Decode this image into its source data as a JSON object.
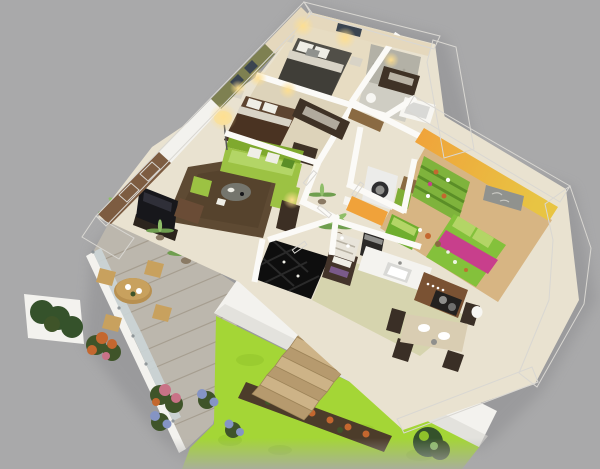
{
  "scene": {
    "title": "Isometric 3D render of a three-bedroom house floor plan with terrace and garden",
    "view": "cutaway dollhouse top-down perspective",
    "background": "#a9a9aa"
  },
  "colors": {
    "bg": "#a9a9aa",
    "wallWhite": "#f3f2ee",
    "wallShade": "#d9d7d2",
    "cream": "#e9e2d0",
    "creamDark": "#ddd3ba",
    "beigeWall": "#e5d8bd",
    "masterFloor": "#e7dcc2",
    "oliveWall": "#7e8051",
    "brownWall": "#7d5c41",
    "windowDark": "#3a4450",
    "stoneWall": "#b3b1a6",
    "stoneFloor": "#cfcdc3",
    "tubWhite": "#f7f6f2",
    "rug": "#5e4a33",
    "rugDark": "#4e3c28",
    "sofa": "#9cc243",
    "sofaLight": "#b3d566",
    "sofaDark": "#7fa92e",
    "pillowWhite": "#efeee6",
    "tableGray": "#75756d",
    "tv": "#17171b",
    "tvStand": "#2c241d",
    "armchair": "#6a4c36",
    "console": "#3c2f24",
    "lampShade": "#f3e1ab",
    "glow": "#ffdf8f",
    "bedGray": "#514f48",
    "bedGrayDark": "#403e38",
    "bedBrown": "#5d4430",
    "bedBrownDark": "#4a3322",
    "foldWhite": "#d8d3c6",
    "wood": "#3f3226",
    "kidsOrange": "#f0a23a",
    "kidsGold": "#e8c443",
    "kidsFloor": "#d7b583",
    "shelfGreen": "#7fb33c",
    "shelfGreenDark": "#5b8e27",
    "kidsBed": "#84c13b",
    "magenta": "#c83f8c",
    "chestGreen": "#6fae2e",
    "frameGray": "#90928e",
    "washer": "#ececea",
    "washerDoor": "#2e2e30",
    "basketGreen": "#7fae35",
    "basketBrown": "#8a6a42",
    "counterWhite": "#f4f3ef",
    "counterWood": "#7a5233",
    "cooktop": "#23211f",
    "sinkGray": "#d9d9d6",
    "coffee": "#2b2927",
    "shelfWood": "#43342a",
    "dishShelf": "#e8e4da",
    "steel": "#8f8f8c",
    "tableTop": "#d9cdb2",
    "chairDark": "#3a2f26",
    "plateWhite": "#ffffff",
    "stackPurple": "#7a5a8a",
    "deck": "#bcb7ad",
    "deckSeam": "#a69e90",
    "glass": "#ccd6d8",
    "glassPost": "#8a9296",
    "rattan": "#c8a15e",
    "rattanDark": "#b89050",
    "palm": "#6f9e4f",
    "palmLight": "#8fbe69",
    "trunk": "#7a5f42",
    "pot": "#8a7a64",
    "hedge": "#35522b",
    "flowerOrange": "#c4672f",
    "flowerPink": "#c97287",
    "foliage": "#3f5429",
    "grass": "#a4d636",
    "grassDark": "#8fc22a",
    "soil": "#4c3c2a",
    "blueFlower": "#8594c4",
    "stepLight": "#cdb387",
    "stepDark": "#b69a6e",
    "stepEdge": "#9d8459",
    "black0": "#0e0e0e",
    "diamond": "#2a2a2a",
    "sage": "#d6d4ae",
    "doorWhite": "#fbfaf7"
  },
  "rooms": {
    "master_bedroom": {
      "label": "Master bedroom",
      "wall": "beige",
      "furniture": [
        "double bed with gray bedding",
        "white patterned pillows",
        "two nightstands",
        "two warm wall sconces",
        "dark wardrobe"
      ]
    },
    "bathroom": {
      "label": "Bathroom",
      "wall": "gray stone tile",
      "furniture": [
        "bathtub",
        "washbasin"
      ]
    },
    "bedroom_2": {
      "label": "Second bedroom",
      "wall": "olive green with dark picture frames",
      "furniture": [
        "double bed with brown bedding",
        "white nightstand with lamp",
        "dark dresser"
      ]
    },
    "hallway": {
      "label": "Hallway with wardrobes",
      "furniture": [
        "open wardrobes with clothes",
        "doors ajar"
      ]
    },
    "living_room": {
      "label": "Living room",
      "wall": "brown accent wall with two windows",
      "furniture": [
        "lime green sofa with white pillows",
        "green pouf",
        "round gray coffee table",
        "flat TV panel on dark stand",
        "brown armchair",
        "dark console with lamp",
        "floor lamp",
        "dark brown area rug",
        "potted palm plants"
      ]
    },
    "entry": {
      "label": "Entry with black diamond tile floor",
      "furniture": [
        "dark storage rack with folded items",
        "tall potted plant"
      ]
    },
    "wc": {
      "label": "WC",
      "furniture": [
        "toilet"
      ]
    },
    "laundry": {
      "label": "Laundry nook",
      "furniture": [
        "front-load washing machine",
        "green laundry basket",
        "brown laundry basket"
      ]
    },
    "kids_bedroom": {
      "label": "Children's bedroom",
      "wall": "orange to golden yellow",
      "furniture": [
        "green toy shelving with toys",
        "single bed with green duvet and magenta throw",
        "green toy chest",
        "toys on floor",
        "gray wall picture"
      ]
    },
    "kitchen": {
      "label": "Kitchen",
      "furniture": [
        "white counter with sink",
        "wood counter with cooktop and two pots",
        "coffee machine",
        "dish shelf"
      ]
    },
    "dining": {
      "label": "Dining area",
      "furniture": [
        "wooden dining table",
        "white plates and pitcher",
        "dark high-back chairs",
        "white clock vase"
      ]
    }
  },
  "outdoor": {
    "terrace": {
      "label": "Wooden deck terrace",
      "features": [
        "frosted glass balustrade with posts",
        "round rattan table with chairs",
        "two potted palms",
        "white planter with dark hedge",
        "orange flower bush",
        "pink flower bush"
      ]
    },
    "garden": {
      "label": "Garden",
      "features": [
        "bright green lawn",
        "flower bed with orange flowers",
        "blue hydrangea bushes",
        "dark shrub",
        "wooden stairs from house"
      ]
    }
  }
}
